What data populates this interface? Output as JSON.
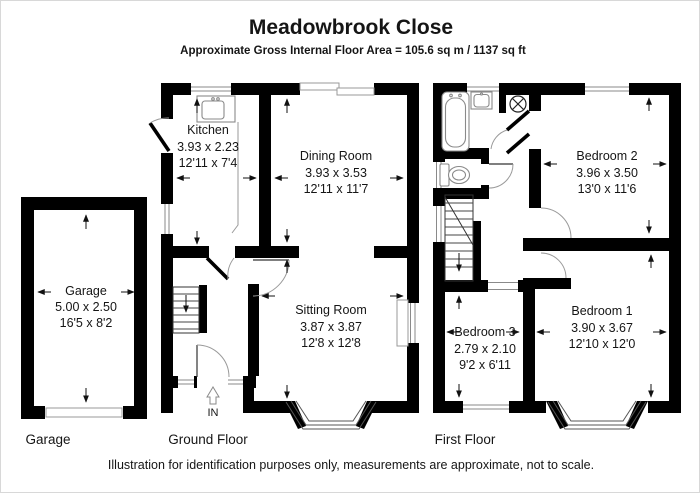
{
  "header": {
    "title": "Meadowbrook Close",
    "subtitle": "Approximate Gross Internal Floor Area = 105.6 sq m / 1137 sq ft"
  },
  "footer": {
    "disclaimer": "Illustration for identification purposes only, measurements are approximate, not to scale."
  },
  "floor_labels": {
    "garage": "Garage",
    "ground": "Ground Floor",
    "first": "First Floor"
  },
  "entrance_label": "IN",
  "rooms": {
    "garage": {
      "name": "Garage",
      "metric": "5.00 x 2.50",
      "imperial": "16'5 x 8'2"
    },
    "kitchen": {
      "name": "Kitchen",
      "metric": "3.93 x 2.23",
      "imperial": "12'11 x 7'4"
    },
    "dining_room": {
      "name": "Dining Room",
      "metric": "3.93 x 3.53",
      "imperial": "12'11 x 11'7"
    },
    "sitting_room": {
      "name": "Sitting Room",
      "metric": "3.87 x 3.87",
      "imperial": "12'8 x 12'8"
    },
    "bedroom_2": {
      "name": "Bedroom 2",
      "metric": "3.96 x 3.50",
      "imperial": "13'0 x 11'6"
    },
    "bedroom_1": {
      "name": "Bedroom 1",
      "metric": "3.90 x 3.67",
      "imperial": "12'10 x 12'0"
    },
    "bedroom_3": {
      "name": "Bedroom 3",
      "metric": "2.79 x 2.10",
      "imperial": "9'2 x 6'11"
    }
  },
  "icons": {
    "fixtures": [
      "bathtub-icon",
      "toilet-icon",
      "bathroom-sink-icon",
      "kitchen-sink-icon",
      "extractor-fan-icon",
      "stairs-icon",
      "bay-window",
      "front-door",
      "in-arrow-icon"
    ]
  },
  "colors": {
    "wall": "#000000",
    "background": "#ffffff",
    "fixture": "#8a8a8a",
    "dimension_arrow": "#111111"
  }
}
